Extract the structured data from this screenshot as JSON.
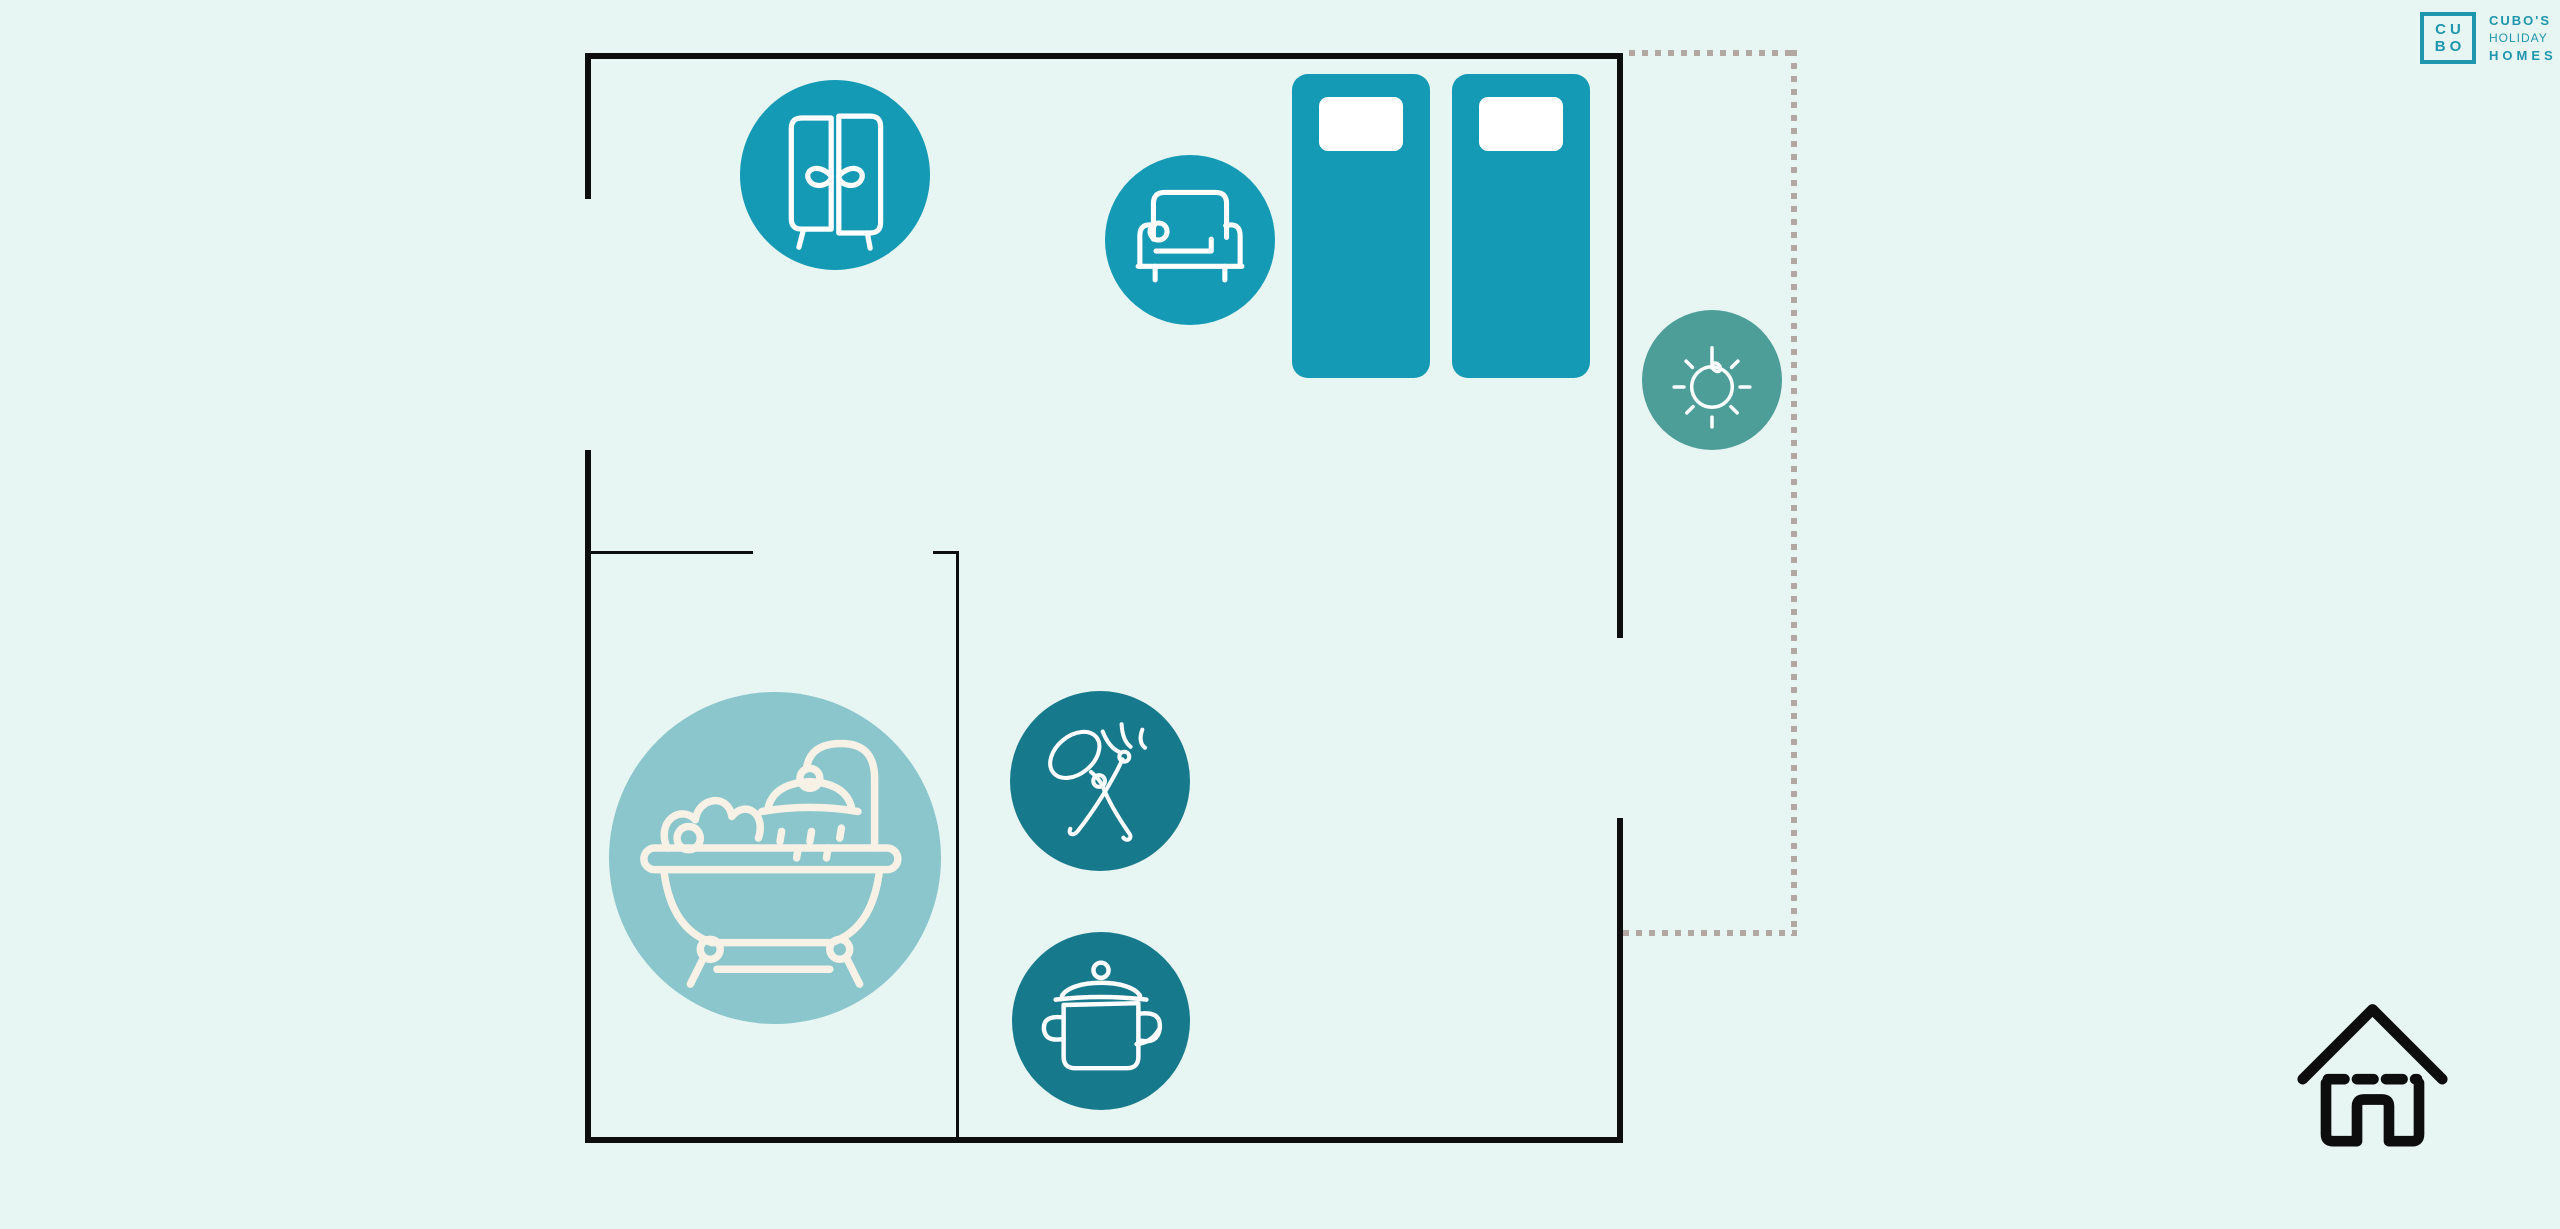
{
  "brand": {
    "monogram_line1": "CU",
    "monogram_line2": "BO",
    "wordmark_line1": "CUBO'S",
    "wordmark_line2": "HOLIDAY",
    "wordmark_line3": "HOMES"
  },
  "colors": {
    "background": "#e7f5f3",
    "walls": "#0d0d0d",
    "furniture_teal": "#149ab5",
    "kitchen_teal": "#177a8c",
    "bath_teal": "#8ac6cc",
    "sun_teal": "#4d9e99",
    "brand_teal": "#1e96ad",
    "balcony_dots": "#b3a7a3",
    "icon_stroke_white": "#ffffff",
    "bath_icon_stroke": "#f7f1e6",
    "pillow_white": "#ffffff",
    "house_icon_black": "#0d0d0d"
  },
  "floorplan": {
    "areas": [
      "bedroom",
      "bathroom",
      "kitchen",
      "balcony"
    ],
    "icons": [
      {
        "name": "wardrobe-icon",
        "meaning": "wardrobe / closet"
      },
      {
        "name": "sofa-icon",
        "meaning": "sofa / seating"
      },
      {
        "name": "bed-shape",
        "meaning": "single bed"
      },
      {
        "name": "bed-shape",
        "meaning": "single bed"
      },
      {
        "name": "sun-icon",
        "meaning": "sunlight / balcony"
      },
      {
        "name": "bathtub-icon",
        "meaning": "bathtub with shower"
      },
      {
        "name": "cutlery-icon",
        "meaning": "dining / eating area"
      },
      {
        "name": "cooking-pot-icon",
        "meaning": "kitchen / cooking"
      },
      {
        "name": "house-icon",
        "meaning": "holiday home"
      }
    ]
  }
}
